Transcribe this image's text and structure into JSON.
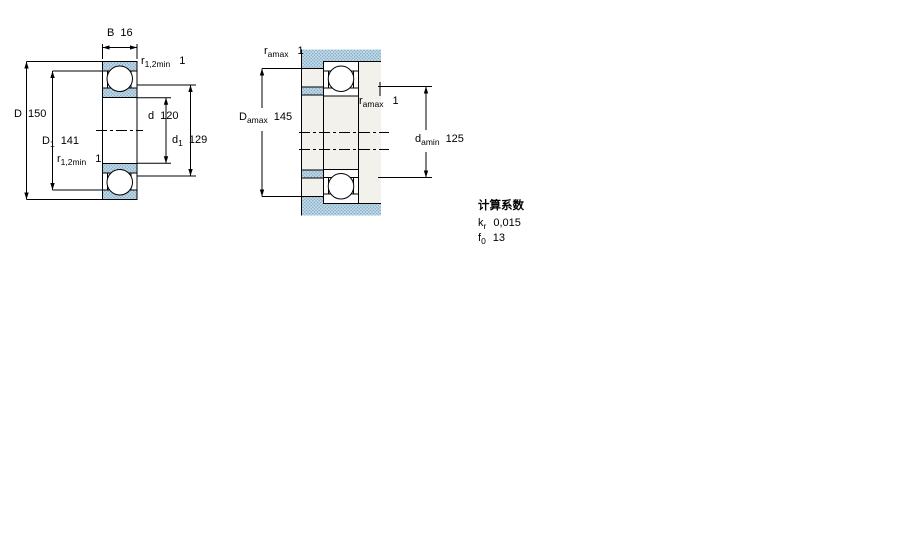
{
  "colors": {
    "line": "#000000",
    "steel_fill_base": "#c6dbe7",
    "steel_fill_dot": "#7aa9c7",
    "section_gray": "#f2f1ec",
    "background": "#ffffff"
  },
  "left_diagram": {
    "name": "bearing cross-section dimensions",
    "labels": {
      "width": {
        "sym": "B",
        "val": "16"
      },
      "r12_top": {
        "sym": "r",
        "sub": "1,2min",
        "val": "1"
      },
      "D": {
        "sym": "D",
        "val": "150"
      },
      "d": {
        "sym": "d",
        "val": "120"
      },
      "D1": {
        "sym": "D",
        "sub": "1",
        "val": "141"
      },
      "d1": {
        "sym": "d",
        "sub": "1",
        "val": "129"
      },
      "r12_bottom": {
        "sym": "r",
        "sub": "1,2min",
        "val": "1"
      }
    }
  },
  "right_diagram": {
    "name": "abutment and fillet dimensions",
    "labels": {
      "ra_top": {
        "sym": "r",
        "sub": "amax",
        "val": "1"
      },
      "Da": {
        "sym": "D",
        "sub": "amax",
        "val": "145"
      },
      "ra_mid": {
        "sym": "r",
        "sub": "amax",
        "val": "1"
      },
      "da": {
        "sym": "d",
        "sub": "amin",
        "val": "125"
      }
    }
  },
  "calculation_factors": {
    "title": "计算系数",
    "rows": [
      {
        "sym": "k",
        "sub": "r",
        "val": "0,015"
      },
      {
        "sym": "f",
        "sub": "0",
        "val": "13"
      }
    ]
  }
}
